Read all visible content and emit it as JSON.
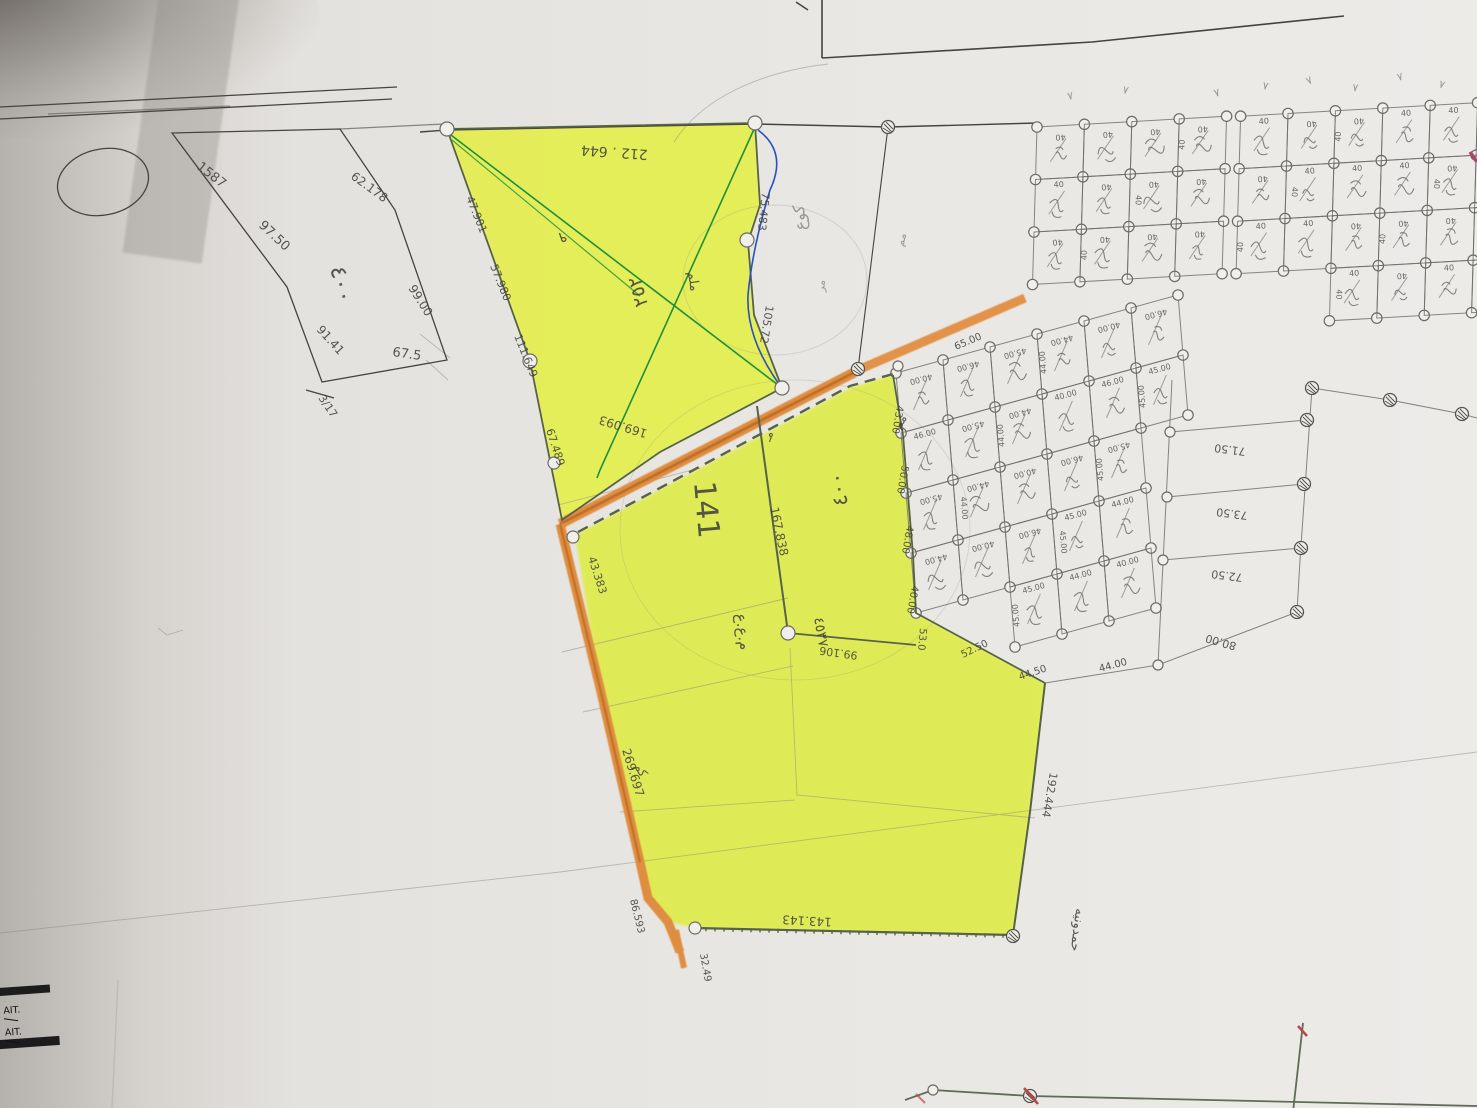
{
  "document": {
    "kind": "hand-drawn cadastral survey sketch (photograph of paper map)",
    "highlight_color": "#e4ef4c",
    "road_color": "#df8d3f"
  },
  "stamp": {
    "line1": "AIT.",
    "line2": "AIT."
  },
  "grid_labels": {
    "top_dim": "40",
    "lower_dims": [
      "40.00",
      "46.00",
      "45.00",
      "44.00"
    ]
  },
  "colors": {
    "pencil": "#41413f",
    "gray": "#8f8d88",
    "green": "#3f5136"
  },
  "grids": {
    "top": {
      "O": [
        1037,
        127
      ],
      "u": [
        47.4,
        -2.7
      ],
      "v": [
        -1.5,
        52.5
      ],
      "cols": 10,
      "rows": 3,
      "splitAt": 4,
      "streetGap": 14,
      "extraCells": [
        [
          6,
          3
        ],
        [
          7,
          3
        ],
        [
          8,
          3
        ],
        [
          9,
          3
        ]
      ],
      "dim": "40"
    },
    "lower": {
      "O": [
        896,
        373
      ],
      "u": [
        47,
        -13
      ],
      "v": [
        5,
        60
      ],
      "cols": 6,
      "rowsPerCol": [
        4,
        4,
        5,
        5,
        5,
        2
      ],
      "dims": [
        "40.00",
        "46.00",
        "45.00",
        "44.00"
      ]
    }
  },
  "annotations": [
    {
      "n": "left-parcel-edge-1587",
      "t": "1587",
      "x": 196,
      "y": 168,
      "r": 38,
      "s": 13
    },
    {
      "n": "left-parcel-edge-97-50",
      "t": "97.50",
      "x": 258,
      "y": 226,
      "r": 43,
      "s": 13
    },
    {
      "n": "left-parcel-area-400",
      "t": "٤٠٠",
      "x": 330,
      "y": 268,
      "r": 76,
      "s": 23
    },
    {
      "n": "left-parcel-edge-62-178",
      "t": "62.178",
      "x": 350,
      "y": 178,
      "r": 36,
      "s": 12
    },
    {
      "n": "left-parcel-edge-99-00",
      "t": "99.00",
      "x": 408,
      "y": 288,
      "r": 58,
      "s": 12
    },
    {
      "n": "left-parcel-edge-91-41",
      "t": "91.41",
      "x": 316,
      "y": 330,
      "r": 48,
      "s": 12
    },
    {
      "n": "left-parcel-edge-67-5",
      "t": "67.5",
      "x": 392,
      "y": 356,
      "r": 8,
      "s": 13
    },
    {
      "n": "left-parcel-corner-3-17",
      "t": "3/17",
      "x": 318,
      "y": 398,
      "r": 56,
      "s": 11
    },
    {
      "n": "yellow-top-edge-212-644",
      "t": "212 . 644",
      "x": 648,
      "y": 150,
      "r": 184,
      "s": 14
    },
    {
      "n": "yellow-left-edge-47-901",
      "t": "47.901",
      "x": 466,
      "y": 198,
      "r": 68,
      "s": 11
    },
    {
      "n": "yellow-left-edge-57-980",
      "t": "57.980",
      "x": 490,
      "y": 266,
      "r": 68,
      "s": 11
    },
    {
      "n": "yellow-left-edge-111-649",
      "t": "111.649",
      "x": 514,
      "y": 336,
      "r": 68,
      "s": 11
    },
    {
      "n": "yellow-left-edge-67-489",
      "t": "67.489",
      "x": 546,
      "y": 430,
      "r": 72,
      "s": 11
    },
    {
      "n": "yellow-right-edge-75-483",
      "t": "75.483",
      "x": 762,
      "y": 192,
      "r": 96,
      "s": 11
    },
    {
      "n": "yellow-right-edge-105-72",
      "t": "105.72",
      "x": 766,
      "y": 305,
      "r": 99,
      "s": 11
    },
    {
      "n": "hw-digit",
      "t": "٩",
      "x": 566,
      "y": 232,
      "r": 170,
      "s": 15
    },
    {
      "n": "hw-plot-number",
      "t": "٢٥٢",
      "x": 648,
      "y": 305,
      "r": -105,
      "s": 19
    },
    {
      "n": "hw-word",
      "t": "ملم",
      "x": 688,
      "y": 272,
      "r": 82,
      "s": 13
    },
    {
      "n": "hw-word",
      "t": "كوع",
      "x": 806,
      "y": 230,
      "r": -95,
      "s": 16,
      "c": "gray"
    },
    {
      "n": "hw-word",
      "t": "مر",
      "x": 824,
      "y": 292,
      "r": -85,
      "s": 11,
      "c": "gray"
    },
    {
      "n": "hw-word",
      "t": "مم",
      "x": 903,
      "y": 247,
      "r": -75,
      "s": 11,
      "c": "gray"
    },
    {
      "n": "road-length-169-093",
      "t": "169.093",
      "x": 648,
      "y": 430,
      "r": 197,
      "s": 12
    },
    {
      "n": "road-length-43-383",
      "t": "43.383",
      "x": 588,
      "y": 558,
      "r": 72,
      "s": 11
    },
    {
      "n": "road-length-269-697",
      "t": "269.697",
      "x": 622,
      "y": 750,
      "r": 73,
      "s": 12
    },
    {
      "n": "road-length-86-593",
      "t": "86.593",
      "x": 630,
      "y": 900,
      "r": 76,
      "s": 10
    },
    {
      "n": "road-length-32-49",
      "t": "32.49",
      "x": 700,
      "y": 954,
      "r": 80,
      "s": 10
    },
    {
      "n": "parcel-number-141",
      "t": "141",
      "x": 694,
      "y": 482,
      "r": 85,
      "s": 30
    },
    {
      "n": "inner-edge-167-838",
      "t": "167.838",
      "x": 770,
      "y": 508,
      "r": 78,
      "s": 12
    },
    {
      "n": "hw-column",
      "t": "م.ع.ع",
      "x": 736,
      "y": 614,
      "r": 84,
      "s": 15
    },
    {
      "n": "hw-column",
      "t": "٤٥٣٧",
      "x": 814,
      "y": 618,
      "r": 80,
      "s": 14
    },
    {
      "n": "lower-parcel-area-400",
      "t": "٤٠٠",
      "x": 848,
      "y": 505,
      "r": -100,
      "s": 21
    },
    {
      "n": "hw-word",
      "t": "مـ",
      "x": 770,
      "y": 442,
      "r": -70,
      "s": 12
    },
    {
      "n": "hw-word",
      "t": "مم",
      "x": 900,
      "y": 430,
      "r": -60,
      "s": 12
    },
    {
      "n": "inner-edge-99-106",
      "t": "99.106",
      "x": 858,
      "y": 652,
      "r": 188,
      "s": 11
    },
    {
      "n": "bottom-edge-143-143",
      "t": "143.143",
      "x": 832,
      "y": 918,
      "r": 183,
      "s": 12
    },
    {
      "n": "right-edge-192-444",
      "t": "192.444",
      "x": 1050,
      "y": 772,
      "r": 100,
      "s": 11
    },
    {
      "n": "hw-owner-name",
      "t": "حمدونيه",
      "x": 1076,
      "y": 908,
      "r": 97,
      "s": 13
    },
    {
      "n": "hw-word",
      "t": "كم",
      "x": 634,
      "y": 766,
      "r": 60,
      "s": 12
    },
    {
      "n": "grid-edge-65-00",
      "t": "65.00",
      "x": 956,
      "y": 350,
      "r": -23,
      "s": 10
    },
    {
      "n": "grid-edge-43-00",
      "t": "43.00",
      "x": 897,
      "y": 405,
      "r": 100,
      "s": 10
    },
    {
      "n": "grid-edge-50-00",
      "t": "50.00",
      "x": 902,
      "y": 465,
      "r": 100,
      "s": 10
    },
    {
      "n": "grid-edge-48-00",
      "t": "48.00",
      "x": 907,
      "y": 525,
      "r": 100,
      "s": 10
    },
    {
      "n": "grid-edge-40-00",
      "t": "40.00",
      "x": 912,
      "y": 585,
      "r": 100,
      "s": 10
    },
    {
      "n": "grid-edge-53-0",
      "t": "53.0",
      "x": 920,
      "y": 628,
      "r": 95,
      "s": 10
    },
    {
      "n": "grid-edge-52-50",
      "t": "52.50",
      "x": 963,
      "y": 658,
      "r": -26,
      "s": 10
    },
    {
      "n": "grid-edge-44-50",
      "t": "44.50",
      "x": 1020,
      "y": 680,
      "r": -18,
      "s": 10
    },
    {
      "n": "grid-edge-44-00",
      "t": "44.00",
      "x": 1100,
      "y": 672,
      "r": -15,
      "s": 10
    },
    {
      "n": "wide-plot-71-50",
      "t": "71.50",
      "x": 1246,
      "y": 448,
      "r": 187,
      "s": 11
    },
    {
      "n": "wide-plot-73-50",
      "t": "73.50",
      "x": 1248,
      "y": 512,
      "r": 187,
      "s": 11
    },
    {
      "n": "wide-plot-72-50",
      "t": "72.50",
      "x": 1243,
      "y": 574,
      "r": 187,
      "s": 11
    },
    {
      "n": "wide-plot-80-00",
      "t": "80.00",
      "x": 1237,
      "y": 643,
      "r": 196,
      "s": 11
    },
    {
      "n": "tick-mark",
      "t": "٧",
      "x": 1068,
      "y": 100,
      "r": -10,
      "s": 11,
      "c": "gray"
    },
    {
      "n": "tick-mark",
      "t": "٧",
      "x": 1122,
      "y": 93,
      "r": 12,
      "s": 11,
      "c": "gray"
    },
    {
      "n": "tick-mark",
      "t": "٧",
      "x": 1215,
      "y": 97,
      "r": -16,
      "s": 11,
      "c": "gray"
    },
    {
      "n": "tick-mark",
      "t": "٧",
      "x": 1262,
      "y": 89,
      "r": 10,
      "s": 11,
      "c": "gray"
    },
    {
      "n": "tick-mark",
      "t": "٧",
      "x": 1308,
      "y": 85,
      "r": -25,
      "s": 11,
      "c": "gray"
    },
    {
      "n": "tick-mark",
      "t": "٧",
      "x": 1352,
      "y": 91,
      "r": 6,
      "s": 11,
      "c": "gray"
    },
    {
      "n": "tick-mark",
      "t": "٧",
      "x": 1398,
      "y": 81,
      "r": -14,
      "s": 11,
      "c": "gray"
    },
    {
      "n": "tick-mark",
      "t": "٧",
      "x": 1438,
      "y": 87,
      "r": 18,
      "s": 11,
      "c": "gray"
    }
  ]
}
